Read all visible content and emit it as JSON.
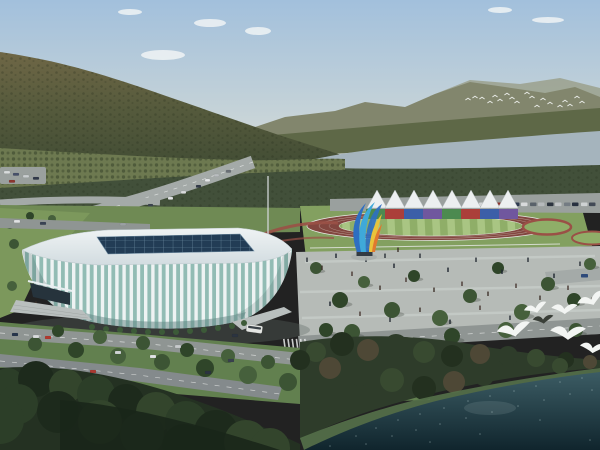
{
  "meta": {
    "type": "architectural-rendering",
    "subject": "Aerial rendering: white gymnasium with glass roof, athletics track with white canopies and rainbow wall, colorful sculpture, plaza with people, roads with cars and bus, forested mountains, river, dark water with seagulls"
  },
  "palette": {
    "skyTop": "#a2c0dc",
    "skyMid": "#c4d2d8",
    "skyHorizon": "#dadedb",
    "cloud": "#f4f6f6",
    "farMountain": "#82866d",
    "farHaze": "#999d87",
    "foothill": "#5e6847",
    "mtnTop": "#6f6746",
    "mtnMid": "#555a3c",
    "mtnDark": "#3e4a33",
    "speckle": "#232b19",
    "river": "#a5b4bd",
    "treeBand": "#42503a",
    "orchard": "#6d7950",
    "orchardRow": "#4a5637",
    "roadGray": "#8f9593",
    "roadLight": "#a4aaa8",
    "parking": "#9aa09e",
    "dashWhite": "#e9ebea",
    "greenStrip": "#6f8a54",
    "lawn": "#7c985c",
    "surround": "#83a060",
    "trackRed": "#82463f",
    "laneLine": "#ccbab0",
    "fieldLight": "#a9c583",
    "fieldDark": "#8fae68",
    "gardenRed": "#9a5046",
    "fence": "#e8eae8",
    "tent": "#eceff0",
    "tentEdge": "#b9c0c2",
    "roofTop": "#eff3f4",
    "roofShade": "#d2dce0",
    "roofEdge": "#c2ced2",
    "skylight": "#223c55",
    "skylightLine": "#6c8aa0",
    "rib": "#eef3f3",
    "glass": "#92bcb4",
    "arch": "#5f8381",
    "entrance": "#26333c",
    "canopy": "#e8eef0",
    "stairs": "#b9bfbe",
    "stairShade": "#9aa09e",
    "plaza": "#b6bbb7",
    "plazaPath": "#c9cecb",
    "pole": "#cfd4d6",
    "shadow": "#5c6662",
    "fgTree": "#243122",
    "fgTreeDark": "#1a261a",
    "shoreBand": "#2e3c2a",
    "shoreGrass": "#55714a",
    "waterTop": "#3c5c64",
    "waterDeep": "#10252d",
    "sparkle": "#cfe4e6",
    "waterGlow": "#cfe0e2",
    "gullWhite": "#f3f5f3",
    "gullDark": "#3a3f38",
    "busBody": "#e4e6e3",
    "busWindow": "#3a4248",
    "sculptBlue": "#2e6fc2",
    "sculptCyan": "#3fa9d9",
    "sculptYellow": "#e9c33b",
    "sculptOrange": "#e0782f",
    "sculptBase": "#333a42",
    "sculptPad": "#a8aeac"
  },
  "treeGreens": [
    "#3c5434",
    "#2f4529",
    "#46603c"
  ],
  "fgGreens": [
    "#2c3e28",
    "#1d2a1c",
    "#33452c"
  ],
  "shoreGreens": [
    "#384a30",
    "#23301f",
    "#4e4836",
    "#2e3c2a"
  ],
  "peopleColors": [
    "#2a3038",
    "#40342c",
    "#1f2630",
    "#4a3a34"
  ],
  "clouds": [
    [
      210,
      23,
      16,
      4
    ],
    [
      163,
      55,
      22,
      5
    ],
    [
      258,
      31,
      13,
      4
    ],
    [
      130,
      12,
      12,
      3
    ],
    [
      548,
      20,
      16,
      3
    ],
    [
      500,
      10,
      12,
      3
    ]
  ],
  "smallBirds": [
    [
      468,
      100
    ],
    [
      475,
      98
    ],
    [
      482,
      99
    ],
    [
      490,
      103
    ],
    [
      495,
      97
    ],
    [
      500,
      101
    ],
    [
      507,
      95
    ],
    [
      512,
      99
    ],
    [
      517,
      103
    ],
    [
      527,
      94
    ],
    [
      532,
      98
    ],
    [
      537,
      107
    ],
    [
      543,
      100
    ],
    [
      550,
      104
    ],
    [
      560,
      107
    ],
    [
      565,
      102
    ],
    [
      570,
      106
    ],
    [
      577,
      98
    ],
    [
      582,
      103
    ]
  ],
  "gulls": [
    {
      "x": 536,
      "y": 311,
      "s": 0.9,
      "rot": -10,
      "dark": false
    },
    {
      "x": 564,
      "y": 312,
      "s": 1.0,
      "rot": 5,
      "dark": false
    },
    {
      "x": 592,
      "y": 303,
      "s": 1.1,
      "rot": -15,
      "dark": false
    },
    {
      "x": 543,
      "y": 322,
      "s": 0.8,
      "rot": 0,
      "dark": true
    },
    {
      "x": 514,
      "y": 334,
      "s": 1.3,
      "rot": -5,
      "dark": false
    },
    {
      "x": 567,
      "y": 337,
      "s": 1.35,
      "rot": 8,
      "dark": false
    },
    {
      "x": 592,
      "y": 351,
      "s": 1.0,
      "rot": 12,
      "dark": false
    }
  ],
  "tents": {
    "centers": [
      377,
      395,
      414,
      433,
      452,
      471,
      490,
      508
    ],
    "apexY": 190,
    "baseY": 208,
    "halfW": 10
  },
  "banner": {
    "x": 366,
    "y": 209,
    "segW": 19,
    "h": 10,
    "colors": [
      "#4c8a50",
      "#ab3f3a",
      "#3c5fa8",
      "#70579e",
      "#4c8a50",
      "#ab3f3a",
      "#3c5fa8",
      "#70579e"
    ]
  },
  "parkingCars": [
    [
      479,
      "#d3d6d7"
    ],
    [
      487,
      "#39445b"
    ],
    [
      496,
      "#8d322c"
    ],
    [
      504,
      "#c6c9cb"
    ],
    [
      513,
      "#2e3a50"
    ],
    [
      521,
      "#d8dadb"
    ],
    [
      530,
      "#59626a"
    ],
    [
      538,
      "#b6babc"
    ],
    [
      547,
      "#2c343f"
    ],
    [
      555,
      "#c0c3c5"
    ],
    [
      564,
      "#747c83"
    ],
    [
      572,
      "#273040"
    ],
    [
      581,
      "#ced2d3"
    ],
    [
      589,
      "#424a56"
    ]
  ],
  "parkingY": 202.5,
  "ulRoadCars": [
    [
      205,
      179,
      "#e6e8e9"
    ],
    [
      214,
      174,
      "#b9bdbf"
    ],
    [
      196,
      185,
      "#333b49"
    ],
    [
      181,
      191,
      "#dadcdd"
    ],
    [
      226,
      170,
      "#6a7076"
    ],
    [
      168,
      197,
      "#e2e4e5"
    ],
    [
      148,
      204,
      "#3c444f"
    ]
  ],
  "leftParkCars": [
    [
      4,
      171,
      "#d8dbdc"
    ],
    [
      13,
      173,
      "#47506a"
    ],
    [
      23,
      175,
      "#c9cdcf"
    ],
    [
      33,
      177,
      "#31394a"
    ],
    [
      9,
      180,
      "#8b3630"
    ]
  ],
  "behindStadiumCars": [
    [
      14,
      220,
      "#e0e2e3"
    ],
    [
      40,
      222,
      "#3a4354"
    ],
    [
      120,
      223,
      "#9ba1a3"
    ]
  ],
  "lowerRoadCars": [
    [
      12,
      333,
      "#27364c"
    ],
    [
      33,
      335,
      "#d8dadc"
    ],
    [
      45,
      336,
      "#b03a30"
    ],
    [
      150,
      355,
      "#e2e4e6"
    ],
    [
      205,
      371,
      "#2c3340"
    ],
    [
      228,
      359,
      "#39414e"
    ],
    [
      90,
      370,
      "#aa3a32"
    ],
    [
      115,
      351,
      "#d0d4d6"
    ],
    [
      175,
      345,
      "#c7cacc"
    ],
    [
      232,
      334,
      "#2c3440"
    ]
  ],
  "bus": {
    "x": 247,
    "y": 324,
    "w": 16,
    "h": 7.5,
    "rot": 8
  },
  "crosswalk": {
    "x": 283,
    "y": 339,
    "n": 6,
    "step": 4.2
  },
  "plazaPeople": [
    [
      307,
      262
    ],
    [
      322,
      270
    ],
    [
      336,
      258
    ],
    [
      352,
      276
    ],
    [
      366,
      262
    ],
    [
      380,
      290
    ],
    [
      394,
      268
    ],
    [
      406,
      282
    ],
    [
      420,
      258
    ],
    [
      434,
      292
    ],
    [
      448,
      272
    ],
    [
      462,
      286
    ],
    [
      476,
      262
    ],
    [
      488,
      296
    ],
    [
      502,
      274
    ],
    [
      516,
      288
    ],
    [
      528,
      262
    ],
    [
      540,
      300
    ],
    [
      554,
      278
    ],
    [
      568,
      290
    ],
    [
      580,
      266
    ],
    [
      592,
      302
    ],
    [
      330,
      306
    ],
    [
      360,
      316
    ],
    [
      390,
      322
    ],
    [
      420,
      312
    ],
    [
      450,
      324
    ],
    [
      480,
      310
    ],
    [
      510,
      320
    ],
    [
      36,
      306
    ],
    [
      50,
      309
    ],
    [
      64,
      303
    ],
    [
      385,
      258
    ],
    [
      398,
      252
    ]
  ],
  "plazaTrees": [
    [
      316,
      268,
      6
    ],
    [
      340,
      300,
      8
    ],
    [
      364,
      282,
      6
    ],
    [
      392,
      310,
      8
    ],
    [
      414,
      276,
      6
    ],
    [
      440,
      318,
      8
    ],
    [
      470,
      296,
      7
    ],
    [
      498,
      268,
      6
    ],
    [
      522,
      312,
      8
    ],
    [
      548,
      284,
      7
    ],
    [
      574,
      300,
      7
    ],
    [
      590,
      264,
      6
    ],
    [
      352,
      332,
      8
    ],
    [
      452,
      336,
      8
    ],
    [
      506,
      330,
      8
    ],
    [
      576,
      330,
      7
    ],
    [
      326,
      330,
      7
    ]
  ],
  "lawnTrees": [
    [
      10,
      224,
      5
    ],
    [
      30,
      216,
      4
    ],
    [
      52,
      219,
      4
    ],
    [
      14,
      244,
      5
    ],
    [
      34,
      260,
      4
    ],
    [
      12,
      286,
      5
    ]
  ],
  "roadTrees": [
    [
      35,
      344,
      7
    ],
    [
      76,
      350,
      8
    ],
    [
      118,
      356,
      8
    ],
    [
      162,
      362,
      8
    ],
    [
      205,
      368,
      9
    ],
    [
      248,
      375,
      9
    ],
    [
      288,
      382,
      9
    ],
    [
      58,
      331,
      6
    ],
    [
      100,
      337,
      7
    ],
    [
      143,
      343,
      7
    ],
    [
      187,
      350,
      7
    ],
    [
      228,
      356,
      7
    ],
    [
      268,
      362,
      7
    ],
    [
      305,
      352,
      6
    ]
  ],
  "stadiumBushes": [
    [
      92,
      327
    ],
    [
      106,
      329
    ],
    [
      120,
      330
    ],
    [
      134,
      331
    ],
    [
      148,
      332
    ],
    [
      162,
      332
    ],
    [
      176,
      332
    ],
    [
      190,
      331
    ],
    [
      204,
      330
    ],
    [
      218,
      328
    ],
    [
      232,
      326
    ],
    [
      244,
      323
    ]
  ],
  "fgTrees": [
    [
      8,
      384,
      16
    ],
    [
      36,
      379,
      18
    ],
    [
      66,
      386,
      17
    ],
    [
      96,
      394,
      19
    ],
    [
      126,
      402,
      18
    ],
    [
      156,
      412,
      20
    ],
    [
      186,
      422,
      21
    ],
    [
      216,
      432,
      22
    ],
    [
      246,
      442,
      22
    ],
    [
      18,
      404,
      20
    ],
    [
      58,
      412,
      21
    ],
    [
      100,
      422,
      22
    ],
    [
      142,
      434,
      22
    ],
    [
      184,
      446,
      22
    ],
    [
      270,
      448,
      20
    ],
    [
      0,
      420,
      24
    ]
  ],
  "shoreTrees": [
    [
      316,
      352,
      10
    ],
    [
      342,
      344,
      12
    ],
    [
      368,
      350,
      11
    ],
    [
      396,
      346,
      12
    ],
    [
      424,
      352,
      11
    ],
    [
      452,
      356,
      11
    ],
    [
      480,
      354,
      10
    ],
    [
      508,
      356,
      10
    ],
    [
      536,
      358,
      9
    ],
    [
      566,
      360,
      8
    ],
    [
      330,
      368,
      11
    ],
    [
      360,
      374,
      12
    ],
    [
      392,
      380,
      12
    ],
    [
      424,
      388,
      12
    ],
    [
      454,
      382,
      11
    ],
    [
      484,
      376,
      10
    ],
    [
      560,
      366,
      8
    ],
    [
      300,
      360,
      10
    ],
    [
      590,
      362,
      7
    ]
  ],
  "waterSparkles": [
    [
      356,
      436
    ],
    [
      376,
      428
    ],
    [
      398,
      420
    ],
    [
      420,
      414
    ],
    [
      444,
      408
    ],
    [
      468,
      401
    ],
    [
      490,
      396
    ],
    [
      514,
      391
    ],
    [
      536,
      386
    ],
    [
      560,
      382
    ],
    [
      582,
      378
    ],
    [
      366,
      444
    ],
    [
      392,
      436
    ],
    [
      416,
      430
    ],
    [
      440,
      424
    ],
    [
      466,
      418
    ],
    [
      492,
      412
    ],
    [
      518,
      406
    ],
    [
      544,
      400
    ],
    [
      570,
      394
    ],
    [
      592,
      390
    ],
    [
      430,
      442
    ],
    [
      480,
      434
    ],
    [
      540,
      420
    ],
    [
      330,
      446
    ],
    [
      590,
      440
    ]
  ]
}
